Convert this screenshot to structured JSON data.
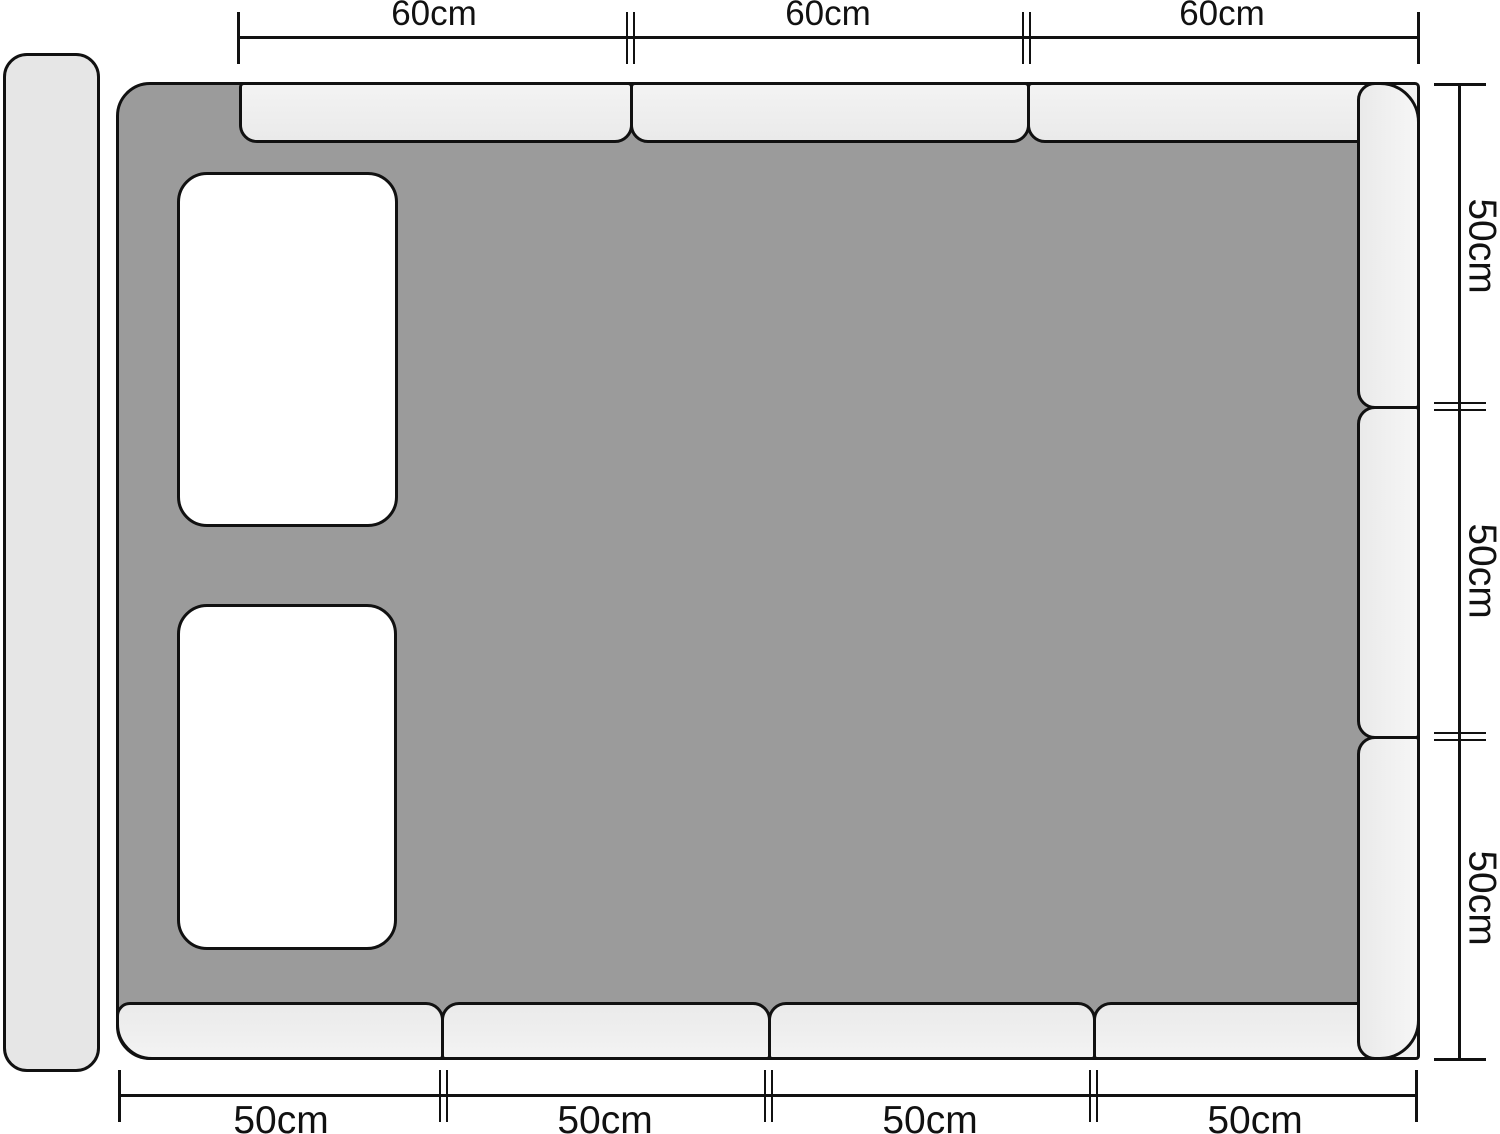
{
  "measurements": {
    "top": [
      "60cm",
      "60cm",
      "60cm"
    ],
    "right": [
      "50cm",
      "50cm",
      "50cm"
    ],
    "bottom": [
      "50cm",
      "50cm",
      "50cm",
      "50cm"
    ]
  },
  "colors": {
    "background": "#ffffff",
    "mattress_gray": "#9b9b9b",
    "bumper_gray": "#efefef",
    "headboard_gray": "#e6e6e6",
    "pillow_white": "#ffffff",
    "outline_black": "#111111"
  },
  "parts": {
    "headboard_count": 1,
    "pillow_count": 2,
    "bumper_count_top": 3,
    "bumper_count_right": 3,
    "bumper_count_bottom": 4
  }
}
